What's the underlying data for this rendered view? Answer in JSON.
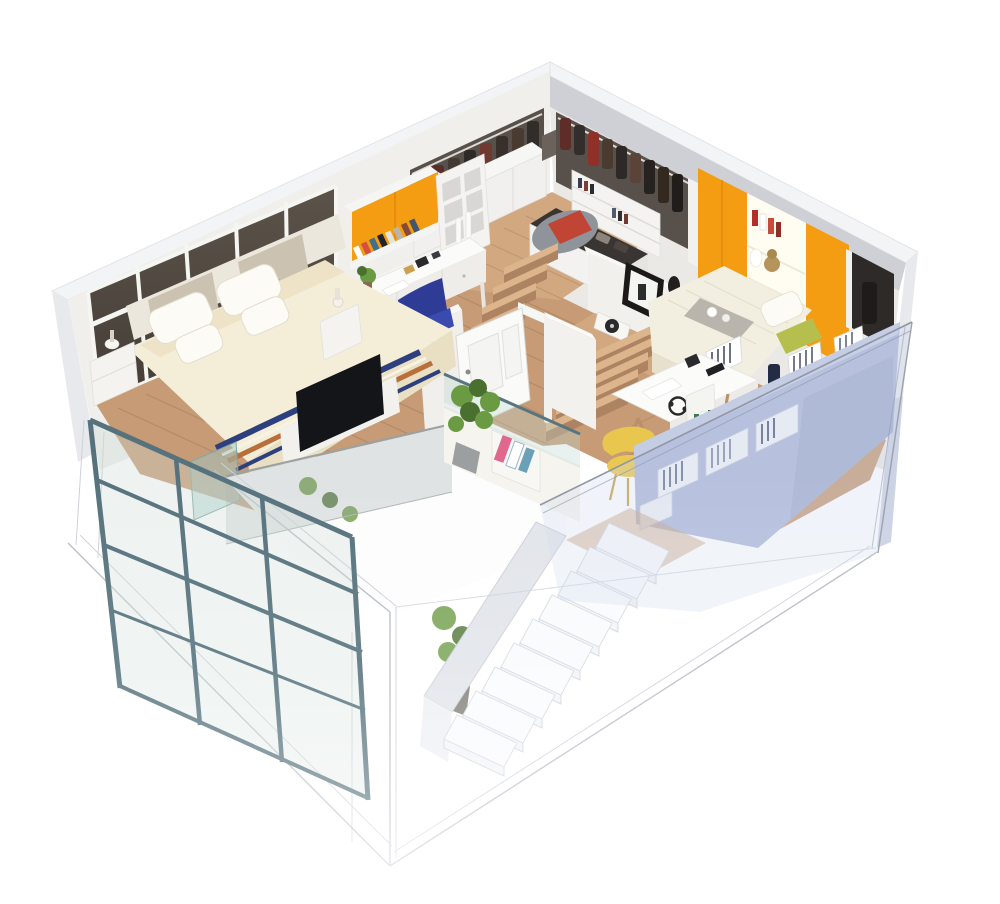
{
  "meta": {
    "title": "3D isometric cutaway floor plan of a two-level loft apartment",
    "view": "bird's-eye isometric cutaway render",
    "levels": 2,
    "background": "white"
  },
  "colors": {
    "bg": "#ffffff",
    "wallCap": "#f3f4f6",
    "wallOuter": "#e7e9ed",
    "wallInner": "#f0efec",
    "wallInner2": "#ebe9e6",
    "ceilStrip": "#cfd0d5",
    "windowTop": "#5b5349",
    "windowBottom": "#453e37",
    "mullion": "#f5f5f2",
    "wood": "#c69b76",
    "woodLight": "#d1a880",
    "stepTop": "#dcb58d",
    "stepRiser": "#ad8362",
    "orange": "#f49d12",
    "navy": "#2e3c96",
    "navySeat": "#3a4aad",
    "yellow": "#e9c64e",
    "periwinkle": "#aeb8d8",
    "periwinkleDeep": "#9aa6c9",
    "periTop": "#c5cde4",
    "teal": "#56727d",
    "ghostLine": "#b9bdc6",
    "ghostFill": "#f4f6f9",
    "bed": "#f4eed9",
    "bedSide": "#e9dfc3",
    "pillow": "#fcfbf5",
    "headboard": "#cbc2b1",
    "clothesBg": "#58514b",
    "clothesDark": "#37302b",
    "maroon": "#6e322c",
    "red": "#8f3129",
    "beanbag": "#8f939a",
    "cushion": "#c04534",
    "green": "#6a9b42",
    "greenDeep": "#49702f",
    "frameDark": "#1b1a19",
    "woodLeg": "#b9906a",
    "tv": "#141519",
    "magPink": "#e0688c",
    "cream": "#f6f4ee"
  },
  "scene": {
    "upper_level": {
      "rooms": [
        {
          "name": "Master bedroom",
          "wall": "floor-to-ceiling smoked-glass window wall with white mullions",
          "furniture": [
            "king bed with cream duvet",
            "four white pillows",
            "striped throw blanket navy and orange",
            "fabric headboard panels",
            "two white nightstands with lamps",
            "flat TV on low white cabinet",
            "teal glass display case"
          ]
        },
        {
          "name": "Study nook",
          "furniture": [
            "white writing desk with drawers",
            "navy blue armchair",
            "orange flap wall cabinet",
            "open shelf with books",
            "white cubby bookcase",
            "white candlestick decor",
            "small desk plant"
          ]
        },
        {
          "name": "Walk-in closet",
          "furniture": [
            "white base cabinets",
            "open rails with hanging jackets and coats",
            "white bookshelf",
            "storage island with folded clothes",
            "grey bean bag with red cushion"
          ]
        },
        {
          "name": "Second bedroom",
          "furniture": [
            "double bed with knit throw and breakfast tray",
            "green bolster pillow",
            "orange wardrobe panels",
            "backlit display shelves with books and bust",
            "white trestle desk with headphones",
            "yellow chair",
            "periwinkle storage wall with book cubbies",
            "leaning framed artwork",
            "two black vases",
            "white record player"
          ]
        }
      ],
      "circulation": [
        "open white panel door",
        "oak steps up to walk-in closet",
        "oak steps down to second bedroom",
        "glass balustrades around stair void",
        "potted plant and magazine rack at landing"
      ]
    },
    "lower_level": {
      "elements": [
        "ghosted translucent white shell walls",
        "floating white staircase of nine treads",
        "glass curtain wall with slate-teal mullions",
        "indoor plant"
      ],
      "rendering": "semi-transparent cutaway fading to white"
    }
  }
}
